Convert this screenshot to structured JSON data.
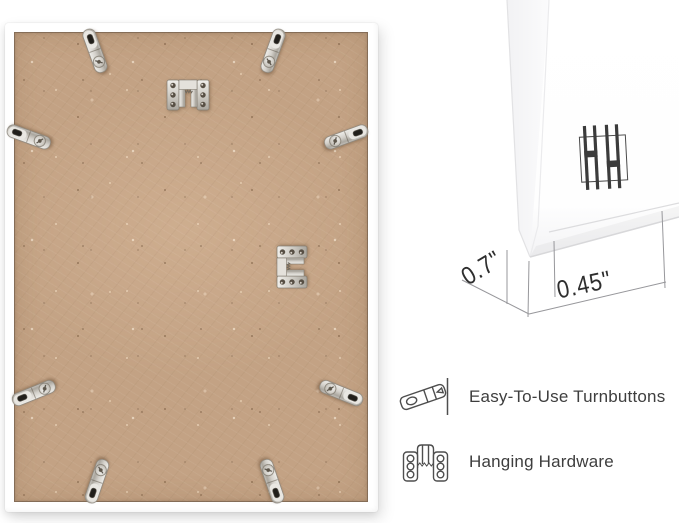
{
  "dimensions": {
    "depth_label": "0.7\"",
    "face_width_label": "0.45\""
  },
  "legend": {
    "items": [
      {
        "icon": "turnbutton-icon",
        "label": "Easy-To-Use Turnbuttons"
      },
      {
        "icon": "hanging-hardware-icon",
        "label": "Hanging Hardware"
      }
    ]
  },
  "photo": {
    "turnbutton_count": 8,
    "hanging_hardware_count": 2
  },
  "icons": {
    "turnbutton": "metal strip with slot hole and screw",
    "hanging_hardware": "u-bracket plate with six screw holes and sawtooth edge",
    "hanging_rails": "four vertical bars with two crossbars"
  },
  "colors": {
    "background": "#ffffff",
    "frame_white": "#ffffff",
    "backing_mdf": "#c3a284",
    "metal": "#cbc7c0",
    "legend_text": "#3e3e3e",
    "dimension_text": "#2e2e2e",
    "dimension_line": "#97979b"
  }
}
